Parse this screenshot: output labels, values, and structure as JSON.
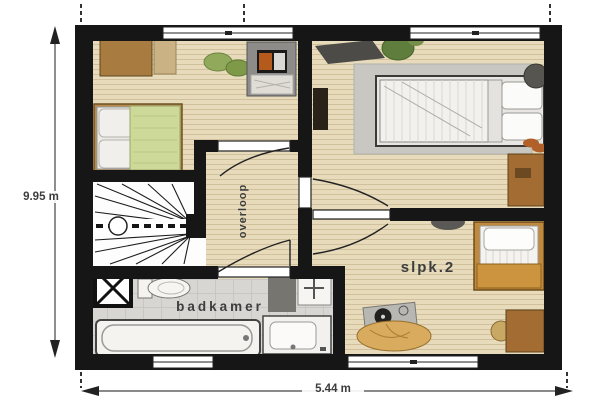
{
  "floor_plan": {
    "room_labels": {
      "landing": "overloop",
      "bathroom": "badkamer",
      "bedroom_2": "slpk.2"
    },
    "dimensions": {
      "height": "9.95 m",
      "width": "5.44 m"
    },
    "palette": {
      "wall": "#161616",
      "wood": "#e7dbbc",
      "bath": "#d8d6d2",
      "stairs": "#fdfdfd",
      "text": "#3d3d3d",
      "brown": "#a26c32",
      "green": "#ccd999",
      "orange": "#c08a3e"
    }
  }
}
